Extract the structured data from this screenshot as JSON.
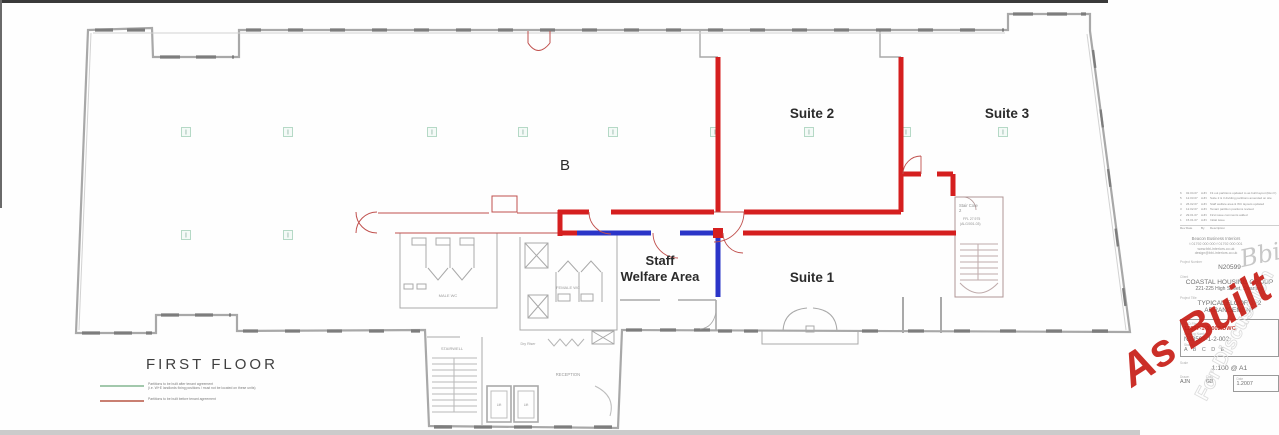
{
  "palette": {
    "red_partition": "#d51f1f",
    "blue_partition": "#2b35c8",
    "thin_red": "#c0504d",
    "wall_gray": "#a8a8a8",
    "column_green": "#b5d9c6",
    "legend_green": "#a2c8ac",
    "legend_red": "#c97f72",
    "stamp_red": "#c82018"
  },
  "plan": {
    "labels": {
      "area_b": "B",
      "suite1": "Suite 1",
      "suite2": "Suite 2",
      "suite3": "Suite 3",
      "welfare1": "Staff",
      "welfare2": "Welfare Area",
      "male_wc": "MALE WC",
      "female_wc": "FEMALE WC",
      "stairwell": "STAIRWELL",
      "reception": "RECEPTION",
      "dry_riser": "Dry Riser",
      "lift_a": "Lift",
      "lift_b": "Lift",
      "stair_core_1": "Stair Core",
      "stair_core_2": "2",
      "stair_core_ffl": "FFL 27.975",
      "stair_core_ref": "(ALG/001-03)",
      "column_symbol": "I"
    },
    "columns": {
      "row1_y": 132,
      "row1_x": [
        186,
        288,
        432,
        523,
        613,
        715,
        809,
        906,
        1003
      ],
      "row2": [
        [
          186,
          235
        ],
        [
          288,
          235
        ]
      ]
    },
    "partitions": {
      "red_segments": [
        [
          718,
          57,
          718,
          212
        ],
        [
          901,
          57,
          901,
          212
        ],
        [
          558,
          212,
          589,
          212
        ],
        [
          611,
          212,
          714,
          212
        ],
        [
          744,
          212,
          901,
          212
        ],
        [
          560,
          210,
          560,
          236
        ],
        [
          558,
          233,
          578,
          233
        ],
        [
          743,
          233,
          956,
          233
        ],
        [
          901,
          174,
          921,
          174
        ],
        [
          937,
          174,
          953,
          174
        ],
        [
          953,
          174,
          953,
          196
        ]
      ],
      "blue_segments": [
        [
          577,
          233,
          651,
          233
        ],
        [
          680,
          233,
          714,
          233
        ],
        [
          718,
          231,
          718,
          297
        ]
      ]
    }
  },
  "legend": {
    "title": "FIRST  FLOOR",
    "items": [
      {
        "color": "#a2c8ac",
        "line1": "Partitions to be built after tenant agreement",
        "line2": "(i.e. W+E landlords fixing positions / must not be located on these units)"
      },
      {
        "color": "#c97f72",
        "line1": "Partitions to be built before tenant agreement",
        "line2": ""
      }
    ]
  },
  "stamps": {
    "as_built": "As Built",
    "watermark": "For Discussion"
  },
  "titleblock": {
    "logo": "Bbi",
    "company_lines": [
      "Beacon Business Interiors",
      "t 01792 000 000   f 01792 000 001",
      "www.bbi-interiors.co.uk",
      "design@bbi-interiors.co.uk"
    ],
    "project_number_label": "Project Number",
    "project_number": "N20599",
    "client_label": "Client",
    "client_line1": "COASTAL HOUSING GROUP",
    "client_line2": "221-225 High Street, Swansea",
    "title_label": "Project Title",
    "title_line1": "TYPICAL FLOOR 1+2",
    "title_line2": "ARRANGEMENT",
    "cad_label": "CAD File",
    "cad_file": "12007-1-2-002.DWG",
    "drg_label": "Drawing Number",
    "drg_number": "N20599-1-2-002",
    "status_label": "Status",
    "status": "A B C D E",
    "scale_label": "Scale",
    "scale": "1:100 @ A1",
    "drawn_label": "Drawn",
    "drawn": "AJN",
    "checked_label": "Chkd",
    "checked": "GB",
    "date_label": "Date",
    "date": "1.2007",
    "rev_head": {
      "no": "Rev",
      "date": "Date",
      "by": "By",
      "desc": "Description"
    },
    "revisions": [
      {
        "no": "6",
        "date": "02.04.07",
        "by": "AJN",
        "desc": "Fit out partitions updated to as built layout (Rev F)"
      },
      {
        "no": "5",
        "date": "12.03.07",
        "by": "AJN",
        "desc": "Suite 2 & 3 dividing partitions amended on site"
      },
      {
        "no": "4",
        "date": "26.02.07",
        "by": "AJN",
        "desc": "Staff welfare area & WC layouts updated"
      },
      {
        "no": "3",
        "date": "12.02.07",
        "by": "AJN",
        "desc": "Tenant partition positions revised"
      },
      {
        "no": "2",
        "date": "29.01.07",
        "by": "AJN",
        "desc": "First issue comments added"
      },
      {
        "no": "1",
        "date": "15.01.07",
        "by": "AJN",
        "desc": "Initial issue"
      }
    ]
  }
}
